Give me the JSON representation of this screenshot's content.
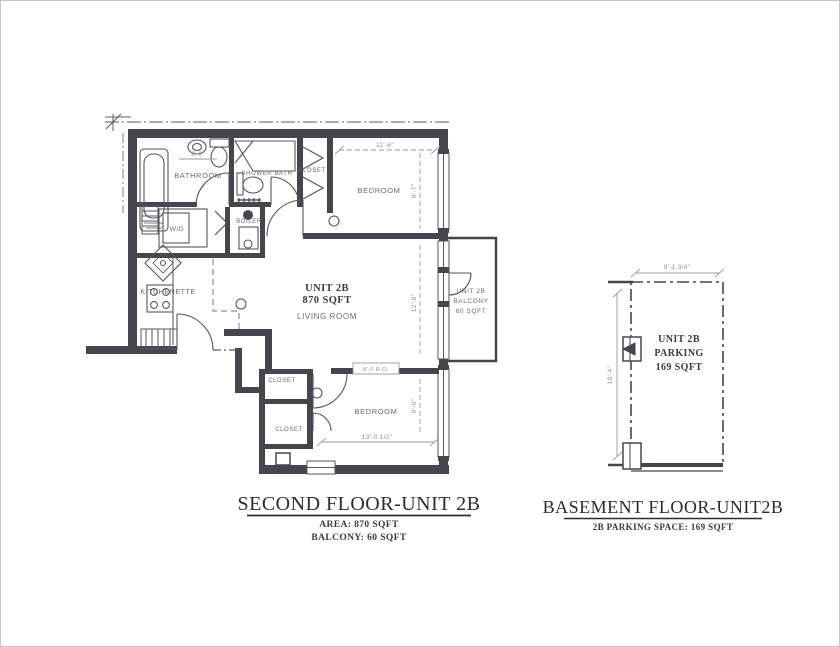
{
  "second_floor": {
    "title": "SECOND FLOOR-UNIT 2B",
    "subtitle_area": "AREA: 870 SQFT",
    "subtitle_balcony": "BALCONY: 60 SQFT",
    "rooms": {
      "bathroom": "BATHROOM",
      "shower_bath": "SHOWER BATH",
      "closet_top": "CLOSET",
      "bedroom_top": "BEDROOM",
      "wd": "W/D",
      "boiler": "BOILER",
      "kitchenette": "KITCHENETTE",
      "unit_no": "UNIT 2B",
      "unit_area": "870 SQFT",
      "living_room": "LIVING ROOM",
      "closet_a": "CLOSET",
      "closet_b": "CLOSET",
      "bedroom_bottom": "BEDROOM",
      "balcony_l1": "UNIT 2B",
      "balcony_l2": "BALCONY",
      "balcony_l3": "60 SQFT"
    },
    "dims": {
      "bed1_width": "11'-6\"",
      "bed1_depth": "9'-7\"",
      "living_depth": "12'-9\"",
      "bed2_width": "13'-0 1/2\"",
      "bed2_depth": "9'-0\"",
      "bath_width": "8'-0\"",
      "slider_tag": "8'-0 R.O."
    }
  },
  "basement": {
    "title": "BASEMENT FLOOR-UNIT2B",
    "subtitle": "2B PARKING SPACE: 169 SQFT",
    "label_l1": "UNIT 2B",
    "label_l2": "PARKING",
    "label_l3": "169 SQFT",
    "dim_width": "9'-1 3/4\"",
    "dim_depth": "18'-4\""
  }
}
